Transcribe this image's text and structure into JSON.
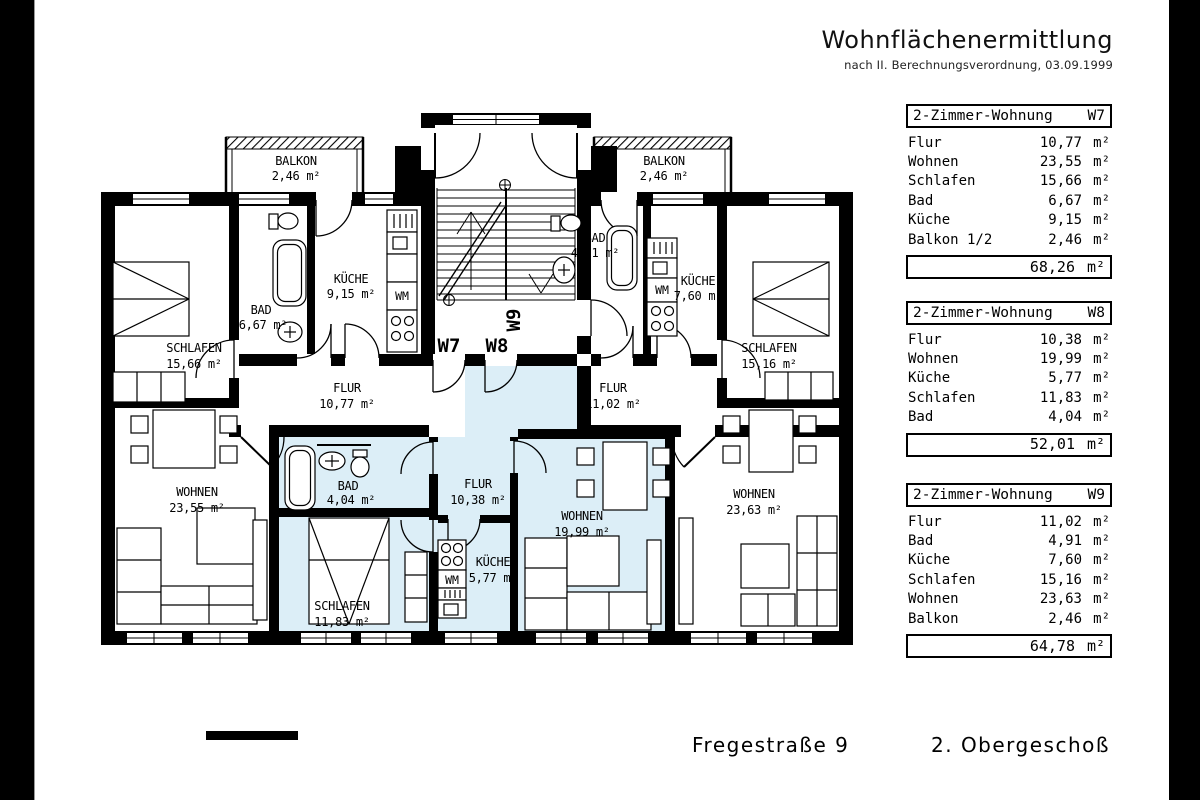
{
  "header": {
    "title": "Wohnflächenermittlung",
    "subtitle": "nach II. Berechnungsverordnung, 03.09.1999"
  },
  "tables": [
    {
      "title": "2-Zimmer-Wohnung",
      "unit_id": "W7",
      "rows": [
        {
          "label": "Flur",
          "value": "10,77",
          "unit": "m²"
        },
        {
          "label": "Wohnen",
          "value": "23,55",
          "unit": "m²"
        },
        {
          "label": "Schlafen",
          "value": "15,66",
          "unit": "m²"
        },
        {
          "label": "Bad",
          "value": "6,67",
          "unit": "m²"
        },
        {
          "label": "Küche",
          "value": "9,15",
          "unit": "m²"
        },
        {
          "label": "Balkon 1/2",
          "value": "2,46",
          "unit": "m²"
        }
      ],
      "total": {
        "value": "68,26",
        "unit": "m²"
      }
    },
    {
      "title": "2-Zimmer-Wohnung",
      "unit_id": "W8",
      "rows": [
        {
          "label": "Flur",
          "value": "10,38",
          "unit": "m²"
        },
        {
          "label": "Wohnen",
          "value": "19,99",
          "unit": "m²"
        },
        {
          "label": "Küche",
          "value": "5,77",
          "unit": "m²"
        },
        {
          "label": "Schlafen",
          "value": "11,83",
          "unit": "m²"
        },
        {
          "label": "Bad",
          "value": "4,04",
          "unit": "m²"
        }
      ],
      "total": {
        "value": "52,01",
        "unit": "m²"
      }
    },
    {
      "title": "2-Zimmer-Wohnung",
      "unit_id": "W9",
      "rows": [
        {
          "label": "Flur",
          "value": "11,02",
          "unit": "m²"
        },
        {
          "label": "Bad",
          "value": "4,91",
          "unit": "m²"
        },
        {
          "label": "Küche",
          "value": "7,60",
          "unit": "m²"
        },
        {
          "label": "Schlafen",
          "value": "15,16",
          "unit": "m²"
        },
        {
          "label": "Wohnen",
          "value": "23,63",
          "unit": "m²"
        },
        {
          "label": "Balkon",
          "value": "2,46",
          "unit": "m²"
        }
      ],
      "total": {
        "value": "64,78",
        "unit": "m²"
      }
    }
  ],
  "footer": {
    "street": "Fregestraße 9",
    "floor": "2. Obergeschoß"
  },
  "floor_plan": {
    "highlight_color": "#dceef7",
    "wm_label": "WM",
    "apartments": {
      "w7": "W7",
      "w8": "W8",
      "w9": "W9"
    },
    "rooms": {
      "balkon_w7": {
        "name": "BALKON",
        "area": "2,46 m²"
      },
      "balkon_w9": {
        "name": "BALKON",
        "area": "2,46 m²"
      },
      "schlafen_w7": {
        "name": "SCHLAFEN",
        "area": "15,66 m²"
      },
      "bad_w7": {
        "name": "BAD",
        "area": "6,67 m²"
      },
      "kueche_w7": {
        "name": "KÜCHE",
        "area": "9,15 m²"
      },
      "flur_w7": {
        "name": "FLUR",
        "area": "10,77 m²"
      },
      "wohnen_w7": {
        "name": "WOHNEN",
        "area": "23,55 m²"
      },
      "bad_w8": {
        "name": "BAD",
        "area": "4,04 m²"
      },
      "schlafen_w8": {
        "name": "SCHLAFEN",
        "area": "11,83 m²"
      },
      "flur_w8": {
        "name": "FLUR",
        "area": "10,38 m²"
      },
      "kueche_w8": {
        "name": "KÜCHE",
        "area": "5,77 m²"
      },
      "wohnen_w8": {
        "name": "WOHNEN",
        "area": "19,99 m²"
      },
      "bad_w9": {
        "name": "BAD",
        "area": "4,91 m²"
      },
      "kueche_w9": {
        "name": "KÜCHE",
        "area": "7,60 m²"
      },
      "schlafen_w9": {
        "name": "SCHLAFEN",
        "area": "15,16 m²"
      },
      "flur_w9": {
        "name": "FLUR",
        "area": "11,02 m²"
      },
      "wohnen_w9": {
        "name": "WOHNEN",
        "area": "23,63 m²"
      }
    }
  }
}
